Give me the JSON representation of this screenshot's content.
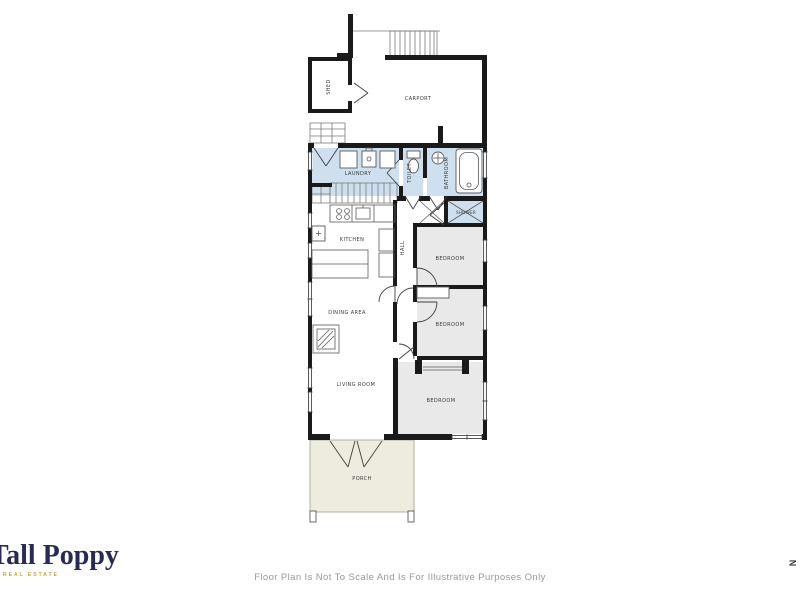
{
  "branding": {
    "logo_text": "Tall Poppy",
    "logo_subtext": "REAL ESTATE",
    "logo_color": "#272b55",
    "logo_accent_color": "#c9a22c"
  },
  "footer": {
    "disclaimer": "Floor Plan Is Not To Scale And Is For Illustrative Purposes Only"
  },
  "compass": {
    "north_label": "N"
  },
  "floor_plan": {
    "colors": {
      "wall": "#1a1a1a",
      "wet_room_fill": "#cee0ef",
      "bedroom_fill": "#e9e9e9",
      "porch_fill": "#edecdf",
      "label_text": "#3a3a3a"
    },
    "labels": {
      "shed": "SHED",
      "carport": "CARPORT",
      "laundry": "LAUNDRY",
      "toilet": "TOILET",
      "bathroom": "BATHROOM",
      "shower": "SHOWER",
      "kitchen": "KITCHEN",
      "hall": "HALL",
      "bedroom1": "BEDROOM",
      "bedroom2": "BEDROOM",
      "bedroom3": "BEDROOM",
      "dining": "DINING AREA",
      "living": "LIVING ROOM",
      "porch": "PORCH"
    }
  }
}
